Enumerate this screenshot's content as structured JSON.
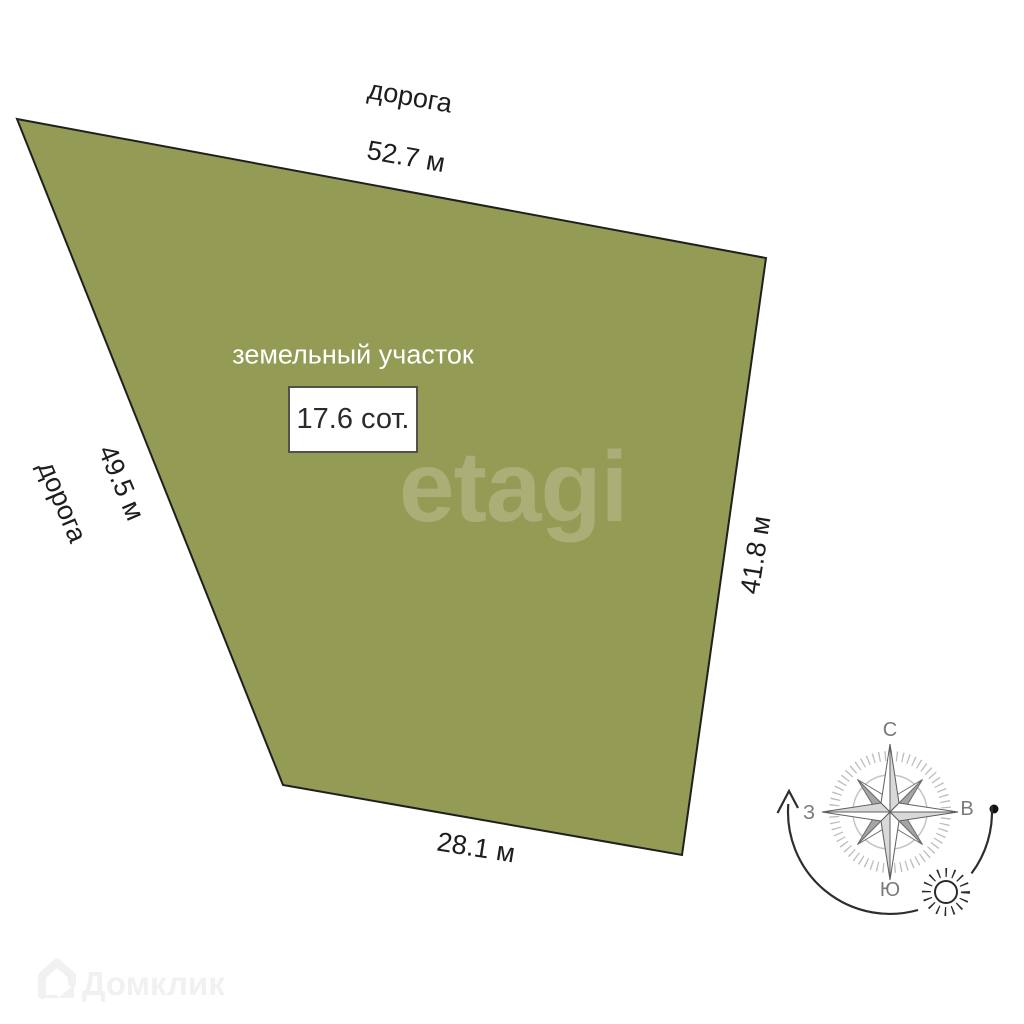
{
  "plot": {
    "label": "земельный участок",
    "area_label": "17.6 сот.",
    "fill_color": "#949B54",
    "border_color": "#1f1f1f",
    "sides": {
      "top": {
        "adjacent": "дорога",
        "length": "52.7 м"
      },
      "left": {
        "adjacent": "дорога",
        "length": "49.5 м"
      },
      "right": {
        "length": "41.8 м"
      },
      "bottom": {
        "length": "28.1 м"
      }
    }
  },
  "compass": {
    "north_label": "С",
    "south_label": "Ю",
    "west_label": "З",
    "east_label": "В"
  },
  "watermarks": {
    "center_logo": "etagi",
    "corner_logo": "Домклик"
  }
}
